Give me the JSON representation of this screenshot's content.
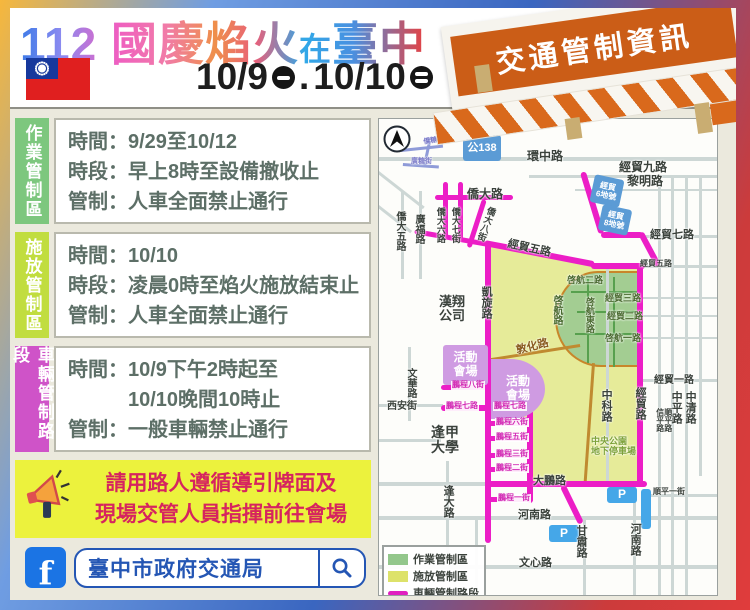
{
  "header": {
    "title_num": "112",
    "title_main": "國慶焰火",
    "title_at": "在",
    "title_city": "臺中",
    "flag_icon": "taiwan-flag",
    "date1": "10/9",
    "date_sep": ".",
    "date2": "10/10",
    "date_icons": [
      "circle-one-bar",
      "circle-two-bar"
    ],
    "banner": "交通管制資訊"
  },
  "info_boxes": [
    {
      "tab": "作業管制區",
      "tab_color": "#7dc77e",
      "lines": [
        "時間：9/29至10/12",
        "時段：早上8時至設備撤收止",
        "管制：人車全面禁止通行"
      ]
    },
    {
      "tab": "施放管制區",
      "tab_color": "#c1dd3f",
      "lines": [
        "時間：10/10",
        "時段：凌晨0時至焰火施放結束止",
        "管制：人車全面禁止通行"
      ]
    },
    {
      "tab": "車輛管制路段",
      "tab_color": "#cf53c8",
      "lines": [
        "時間：10/9下午2時起至",
        "　　　10/10晚間10時止",
        "管制：一般車輛禁止通行"
      ]
    }
  ],
  "notice": {
    "icon": "megaphone",
    "lines": [
      "請用路人遵循導引牌面及",
      "現場交管人員指揮前往會場"
    ]
  },
  "footer": {
    "facebook_label": "f",
    "account": "臺中市政府交通局",
    "search_icon": "magnifier"
  },
  "map": {
    "north_icon": "north-arrow",
    "legend": [
      {
        "label": "作業管制區",
        "swatch": "#93c78c",
        "type": "fill"
      },
      {
        "label": "施放管制區",
        "swatch": "#dde26a",
        "type": "fill"
      },
      {
        "label": "車輛管制路段",
        "swatch": "#e01fc0",
        "type": "line"
      }
    ],
    "labels": [
      {
        "t": "環中路",
        "x": 148,
        "y": 31,
        "s": 12
      },
      {
        "t": "經貿九路",
        "x": 240,
        "y": 42,
        "s": 12
      },
      {
        "t": "黎明路",
        "x": 248,
        "y": 56,
        "s": 12
      },
      {
        "t": "僑大路",
        "x": 88,
        "y": 69,
        "s": 12
      },
      {
        "t": "僑大五路",
        "x": 15,
        "y": 92,
        "s": 10,
        "v": 1
      },
      {
        "t": "廣福路",
        "x": 34,
        "y": 95,
        "s": 10,
        "v": 1
      },
      {
        "t": "僑大六路",
        "x": 56,
        "y": 88,
        "s": 9,
        "v": 1
      },
      {
        "t": "僑大七街",
        "x": 71,
        "y": 88,
        "s": 9,
        "v": 1
      },
      {
        "t": "僑大八街",
        "x": 108,
        "y": 86,
        "s": 9,
        "v": 1,
        "r": 20
      },
      {
        "t": "僑糖街",
        "x": 44,
        "y": 20,
        "s": 7,
        "c": "#7a7ac8",
        "r": -10
      },
      {
        "t": "廣糖街",
        "x": 32,
        "y": 39,
        "s": 7,
        "c": "#7a7ac8"
      },
      {
        "t": "經貿七路",
        "x": 271,
        "y": 110,
        "s": 11
      },
      {
        "t": "經貿五路",
        "x": 130,
        "y": 119,
        "s": 11,
        "r": 12
      },
      {
        "t": "經貿五路",
        "x": 261,
        "y": 141,
        "s": 8
      },
      {
        "t": "漢翔/公司",
        "x": 60,
        "y": 176,
        "s": 13
      },
      {
        "t": "凱旋路",
        "x": 101,
        "y": 167,
        "s": 11,
        "v": 1
      },
      {
        "t": "啓航二路",
        "x": 188,
        "y": 157,
        "s": 9,
        "c": "#4a6a30"
      },
      {
        "t": "經貿三路",
        "x": 226,
        "y": 175,
        "s": 9,
        "c": "#4a6a30"
      },
      {
        "t": "經貿二路",
        "x": 228,
        "y": 193,
        "s": 9,
        "c": "#4a6a30"
      },
      {
        "t": "啓航一路",
        "x": 226,
        "y": 215,
        "s": 9,
        "c": "#4a6a30"
      },
      {
        "t": "啓航路",
        "x": 172,
        "y": 176,
        "s": 10,
        "v": 1,
        "c": "#4a6a30"
      },
      {
        "t": "啓航東路",
        "x": 205,
        "y": 178,
        "s": 9,
        "v": 1,
        "c": "#4a6a30"
      },
      {
        "t": "敦化路",
        "x": 136,
        "y": 226,
        "s": 11,
        "r": -14,
        "c": "#8a5c20"
      },
      {
        "t": "中科路",
        "x": 221,
        "y": 270,
        "s": 11,
        "v": 1
      },
      {
        "t": "經貿路",
        "x": 255,
        "y": 268,
        "s": 11,
        "v": 1
      },
      {
        "t": "經貿一路",
        "x": 275,
        "y": 256,
        "s": 10
      },
      {
        "t": "中平路",
        "x": 291,
        "y": 272,
        "s": 11,
        "v": 1
      },
      {
        "t": "中清路",
        "x": 305,
        "y": 272,
        "s": 11,
        "v": 1
      },
      {
        "t": "信平路",
        "x": 276,
        "y": 289,
        "s": 8,
        "v": 1
      },
      {
        "t": "順平路",
        "x": 284,
        "y": 289,
        "s": 8,
        "v": 1
      },
      {
        "t": "文華路",
        "x": 26,
        "y": 249,
        "s": 10,
        "v": 1
      },
      {
        "t": "西安街",
        "x": 8,
        "y": 282,
        "s": 10
      },
      {
        "t": "逢甲/大學",
        "x": 52,
        "y": 306,
        "s": 14
      },
      {
        "t": "逢大路",
        "x": 63,
        "y": 366,
        "s": 11,
        "v": 1
      },
      {
        "t": "大鵬路",
        "x": 154,
        "y": 356,
        "s": 11
      },
      {
        "t": "河南路",
        "x": 139,
        "y": 390,
        "s": 11
      },
      {
        "t": "甘肅路",
        "x": 196,
        "y": 406,
        "s": 11,
        "v": 1
      },
      {
        "t": "河南路",
        "x": 250,
        "y": 404,
        "s": 11,
        "v": 1
      },
      {
        "t": "文心路",
        "x": 140,
        "y": 438,
        "s": 11
      },
      {
        "t": "順平一街",
        "x": 274,
        "y": 369,
        "s": 8
      },
      {
        "t": "中央公園/地下停車場",
        "x": 212,
        "y": 318,
        "s": 9,
        "c": "#7da23a"
      },
      {
        "t": "鵬程八街",
        "x": 72,
        "y": 262,
        "s": 8,
        "c": "#d22ab4",
        "chip": 1
      },
      {
        "t": "鵬程七路",
        "x": 66,
        "y": 283,
        "s": 8,
        "c": "#d22ab4",
        "chip": 1
      },
      {
        "t": "鵬程七路",
        "x": 114,
        "y": 283,
        "s": 8,
        "c": "#d22ab4",
        "chip": 1
      },
      {
        "t": "鵬程六街",
        "x": 116,
        "y": 299,
        "s": 8,
        "c": "#d22ab4",
        "chip": 1
      },
      {
        "t": "鵬程五街",
        "x": 116,
        "y": 314,
        "s": 8,
        "c": "#d22ab4",
        "chip": 1
      },
      {
        "t": "鵬程三街",
        "x": 116,
        "y": 331,
        "s": 8,
        "c": "#d22ab4",
        "chip": 1
      },
      {
        "t": "鵬程二街",
        "x": 116,
        "y": 345,
        "s": 8,
        "c": "#d22ab4",
        "chip": 1
      },
      {
        "t": "鵬程一街",
        "x": 118,
        "y": 375,
        "s": 8,
        "c": "#d22ab4",
        "chip": 1
      }
    ],
    "areas": [
      {
        "t": "公138",
        "x": 84,
        "y": 16,
        "w": 38,
        "h": 26,
        "bg": "#5b9bd5",
        "fs": 11
      },
      {
        "t": "經貿/6地號",
        "x": 213,
        "y": 58,
        "w": 30,
        "h": 28,
        "bg": "#5b9bd5",
        "fs": 8,
        "r": 12
      },
      {
        "t": "經貿/8地號",
        "x": 221,
        "y": 88,
        "w": 30,
        "h": 26,
        "bg": "#5b9bd5",
        "fs": 8,
        "r": 12
      },
      {
        "t": "活動/會場",
        "x": 64,
        "y": 226,
        "w": 45,
        "h": 40,
        "bg": "#cf9be2",
        "fs": 12
      },
      {
        "t": "活動/會場",
        "x": 112,
        "y": 240,
        "w": 54,
        "h": 60,
        "bg": "#cf9be2",
        "fs": 12,
        "radius": "0 70% 70% 0 / 0 55% 55% 0"
      },
      {
        "t": "P",
        "x": 170,
        "y": 406,
        "w": 30,
        "h": 17,
        "bg": "#45a7e8",
        "fs": 12
      },
      {
        "t": "P",
        "x": 228,
        "y": 368,
        "w": 30,
        "h": 16,
        "bg": "#45a7e8",
        "fs": 12
      },
      {
        "t": "",
        "x": 262,
        "y": 370,
        "w": 10,
        "h": 40,
        "bg": "#45a7e8",
        "fs": 7
      }
    ],
    "roads": {
      "gray": [
        [
          0,
          38,
          340,
          4
        ],
        [
          150,
          56,
          190,
          3
        ],
        [
          196,
          70,
          144,
          2
        ],
        [
          264,
          116,
          76,
          3
        ],
        [
          264,
          146,
          76,
          3
        ],
        [
          264,
          178,
          76,
          2
        ],
        [
          264,
          196,
          76,
          2
        ],
        [
          264,
          218,
          76,
          2
        ],
        [
          264,
          260,
          76,
          3
        ],
        [
          262,
          375,
          78,
          3
        ],
        [
          0,
          363,
          110,
          4
        ],
        [
          0,
          397,
          340,
          4
        ],
        [
          0,
          446,
          340,
          4
        ],
        [
          0,
          285,
          64,
          3
        ],
        [
          0,
          320,
          62,
          3
        ],
        [
          22,
          72,
          3,
          88
        ],
        [
          40,
          72,
          3,
          88
        ],
        [
          29,
          228,
          3,
          74
        ],
        [
          67,
          342,
          3,
          92
        ],
        [
          204,
          401,
          3,
          77
        ],
        [
          254,
          363,
          3,
          115
        ],
        [
          227,
          148,
          3,
          215
        ],
        [
          279,
          57,
          3,
          420
        ],
        [
          292,
          57,
          3,
          420
        ],
        [
          306,
          57,
          3,
          420
        ],
        [
          320,
          57,
          3,
          300
        ],
        [
          0,
          52,
          58,
          3,
          38
        ],
        [
          0,
          86,
          42,
          3,
          38
        ],
        [
          96,
          399,
          3,
          79
        ]
      ],
      "pink": [
        [
          56,
          76,
          78,
          5
        ],
        [
          64,
          63,
          5,
          58
        ],
        [
          79,
          63,
          5,
          58
        ],
        [
          36,
          110,
          78,
          5,
          10
        ],
        [
          103,
          80,
          5,
          50,
          18
        ],
        [
          106,
          121,
          112,
          6,
          11
        ],
        [
          212,
          144,
          54,
          6
        ],
        [
          106,
          124,
          6,
          300
        ],
        [
          258,
          146,
          6,
          222
        ],
        [
          201,
          54,
          6,
          64,
          -17
        ],
        [
          222,
          113,
          42,
          6
        ],
        [
          259,
          115,
          6,
          38,
          -28
        ],
        [
          148,
          288,
          6,
          96
        ],
        [
          62,
          266,
          48,
          5
        ],
        [
          62,
          286,
          94,
          6
        ],
        [
          108,
          302,
          46,
          5
        ],
        [
          108,
          317,
          46,
          5
        ],
        [
          108,
          334,
          46,
          5
        ],
        [
          108,
          348,
          46,
          5
        ],
        [
          106,
          362,
          162,
          6
        ],
        [
          108,
          378,
          46,
          5
        ],
        [
          181,
          368,
          6,
          42,
          -26
        ]
      ],
      "blue": [
        [
          22,
          30,
          42,
          3,
          -6
        ],
        [
          24,
          44,
          36,
          3,
          4
        ],
        [
          50,
          18,
          3,
          30,
          12
        ]
      ],
      "tan": [
        [
          106,
          240,
          96,
          3,
          -9
        ],
        [
          213,
          244,
          3,
          122,
          4
        ]
      ]
    }
  }
}
